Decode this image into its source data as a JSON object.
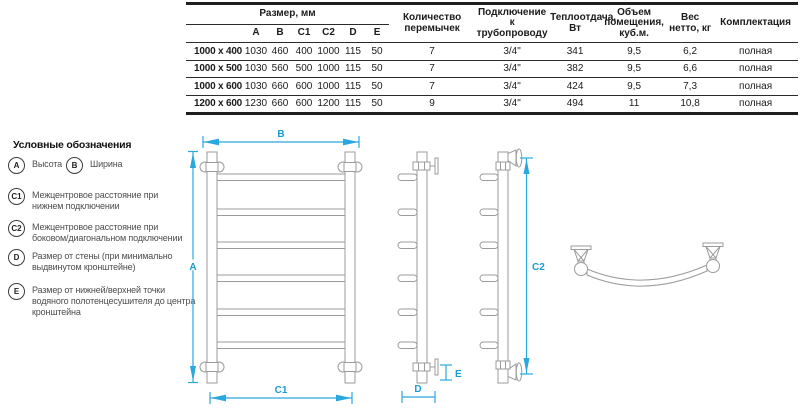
{
  "colors": {
    "accent_blue": "#29a8df",
    "drawing_gray": "#9b9b9b",
    "table_line": "#1f1f1f"
  },
  "table": {
    "group_header": "Размер, мм",
    "size_cols": [
      "A",
      "B",
      "C1",
      "C2",
      "D",
      "E"
    ],
    "columns": [
      "Количество перемычек",
      "Подключение к трубопроводу",
      "Теплоотдача, Вт",
      "Объем помещения, куб.м.",
      "Вес нетто, кг",
      "Комплектация"
    ],
    "rows": [
      {
        "model": "1000 x 400",
        "values": [
          "1030",
          "460",
          "400",
          "1000",
          "115",
          "50",
          "7",
          "3/4\"",
          "341",
          "9,5",
          "6,2",
          "полная"
        ]
      },
      {
        "model": "1000 x 500",
        "values": [
          "1030",
          "560",
          "500",
          "1000",
          "115",
          "50",
          "7",
          "3/4\"",
          "382",
          "9,5",
          "6,6",
          "полная"
        ]
      },
      {
        "model": "1000 x 600",
        "values": [
          "1030",
          "660",
          "600",
          "1000",
          "115",
          "50",
          "7",
          "3/4\"",
          "424",
          "9,5",
          "7,3",
          "полная"
        ]
      },
      {
        "model": "1200 x 600",
        "values": [
          "1230",
          "660",
          "600",
          "1200",
          "115",
          "50",
          "9",
          "3/4\"",
          "494",
          "11",
          "10,8",
          "полная"
        ]
      }
    ]
  },
  "legend": {
    "title": "Условные обозначения",
    "items": [
      {
        "key": "A",
        "label": "Высота"
      },
      {
        "key": "B",
        "label": "Ширина"
      },
      {
        "key": "C1",
        "label": "Межцентровое расстояние при нижнем подключении"
      },
      {
        "key": "C2",
        "label": "Межцентровое расстояние при боковом/диагональном подключении"
      },
      {
        "key": "D",
        "label": "Размер от стены (при минимально выдвинутом кронштейне)"
      },
      {
        "key": "E",
        "label": "Размер от нижней/верхней точки водяного полотенцесушителя до центра кронштейна"
      }
    ]
  },
  "diagram": {
    "labels": {
      "A": "A",
      "B": "B",
      "C1": "C1",
      "C2": "C2",
      "D": "D",
      "E": "E"
    }
  }
}
